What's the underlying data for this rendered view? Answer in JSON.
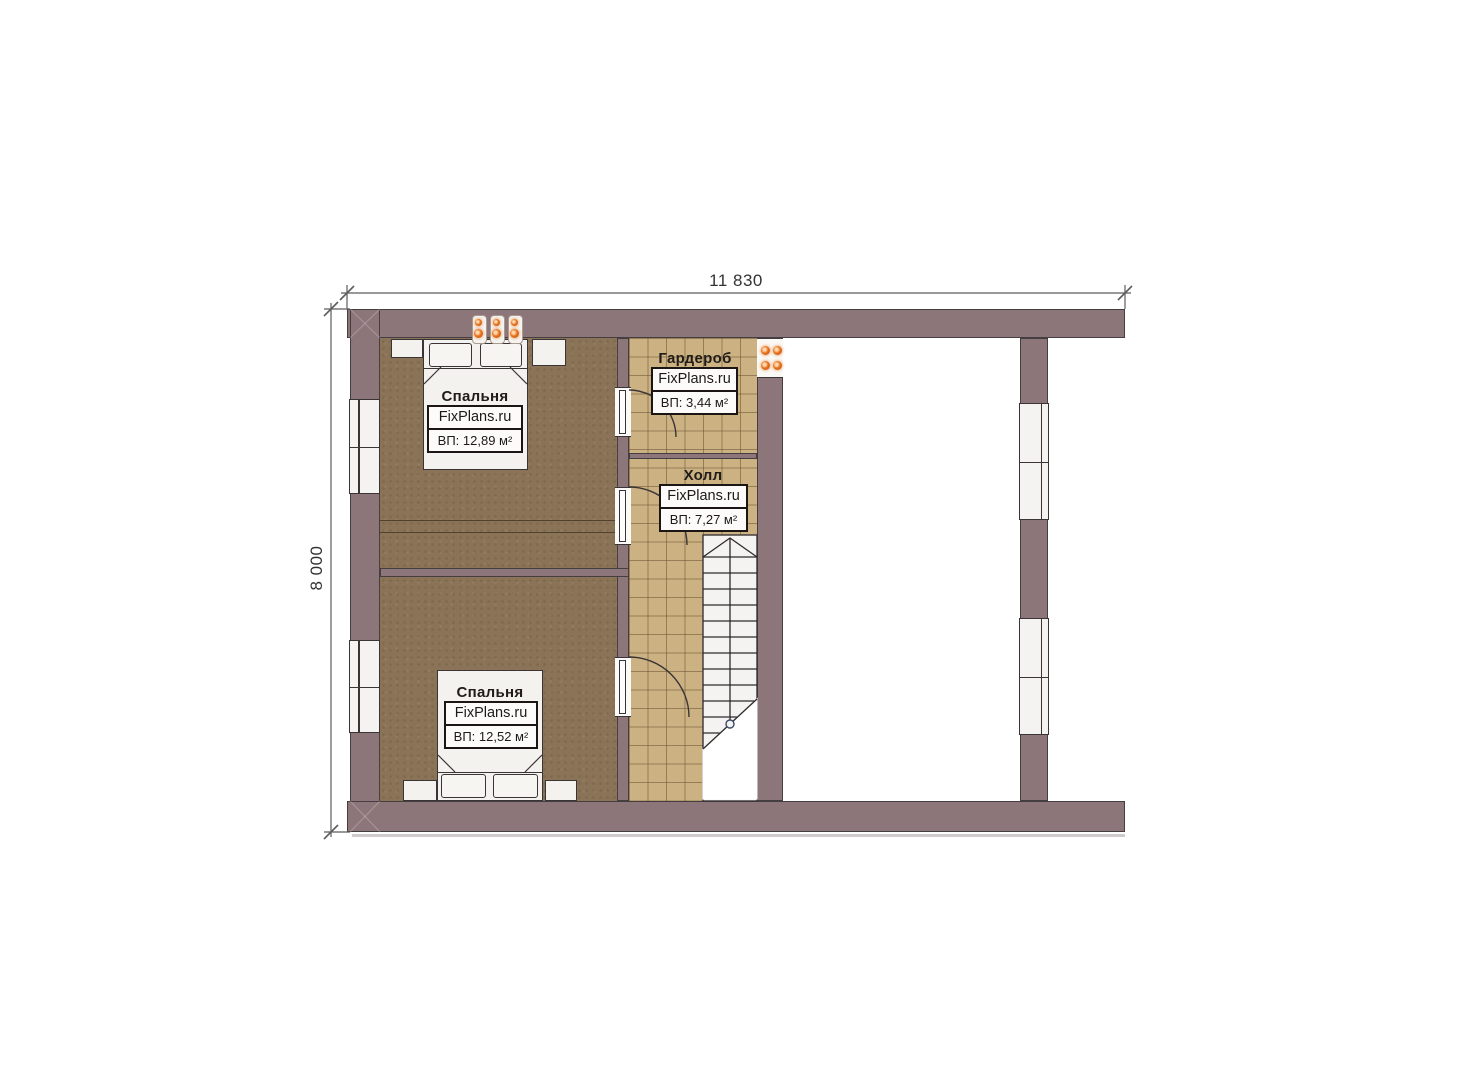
{
  "dimensions": {
    "width": "11 830",
    "height": "8 000"
  },
  "rooms": {
    "bedroom1": {
      "name": "Спальня",
      "brand": "FixPlans.ru",
      "area": "ВП: 12,89 м²"
    },
    "wardrobe": {
      "name": "Гардероб",
      "brand": "FixPlans.ru",
      "area": "ВП: 3,44 м²"
    },
    "hall": {
      "name": "Холл",
      "brand": "FixPlans.ru",
      "area": "ВП: 7,27 м²"
    },
    "bedroom2": {
      "name": "Спальня",
      "brand": "FixPlans.ru",
      "area": "ВП: 12,52 м²"
    }
  },
  "colors": {
    "wall": "#8d767a",
    "carpet": "#8a7356",
    "tile": "#ccb183",
    "accent_light": "#e8731f",
    "outline": "#3a3436",
    "dimension": "#5c5c5c"
  }
}
